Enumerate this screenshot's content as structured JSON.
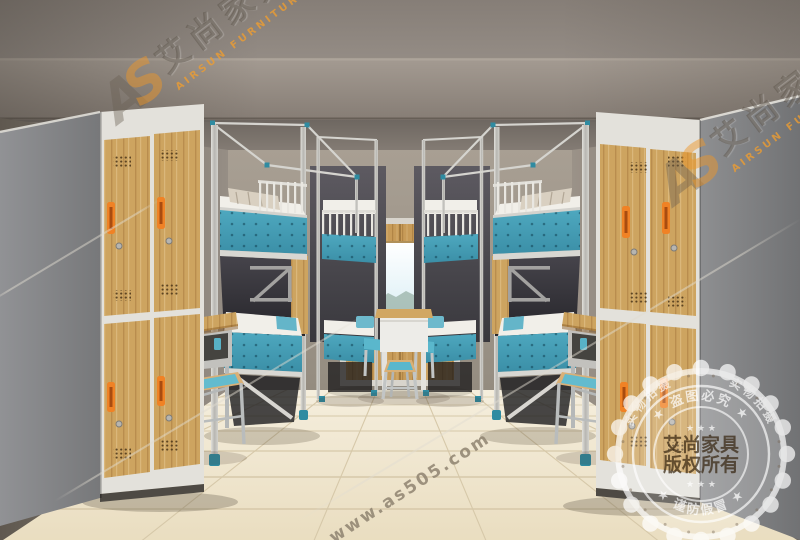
{
  "watermarks": {
    "logo": {
      "glyph_a": "A",
      "glyph_s": "S",
      "cn": "艾尚家具",
      "en": "AIRSUN FURNITURE"
    },
    "url": "www.as505.com",
    "stamp": {
      "center_line1": "艾尚家具",
      "center_line2": "版权所有",
      "stars_top": "★ ★ ★",
      "stars_bottom": "★ ★ ★",
      "arc_top": "★ 盗图必究 ★",
      "arc_bottom": "★ 谨防假冒 ★",
      "arc_left": "实物拍摄",
      "arc_right": "实物拍摄"
    }
  },
  "palette": {
    "wall": "#8b8279",
    "wall_dark": "#665f58",
    "wall_light": "#a49b8f",
    "floor": "#efe5cd",
    "grout": "#d6c8a9",
    "wood": "#cda460",
    "wood_dark": "#a87f42",
    "metal": "#cccbc6",
    "frame_white": "#e3e1db",
    "blue": "#4ea8bf",
    "blue_deep": "#3b8fa7",
    "teal_cap": "#2f8ba1",
    "orange": "#f08225",
    "bedding": "#f1efe9",
    "pillow": "#d9d0c1",
    "stamp_text": "#3e2d1a"
  }
}
